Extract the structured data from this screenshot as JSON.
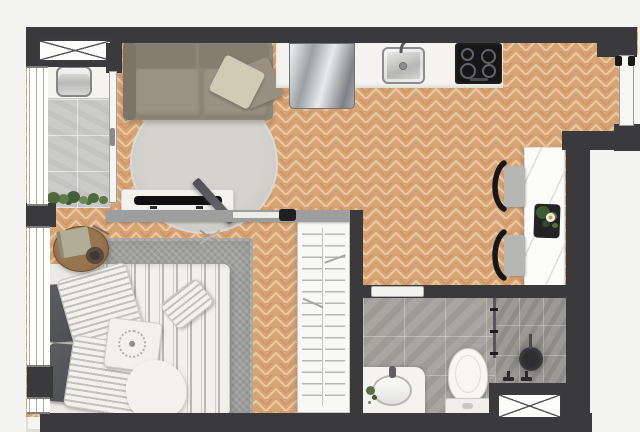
{
  "image_type": "apartment_floor_plan_rendering",
  "visible_text": [],
  "palette": {
    "exterior_bg": "#f4f4f2",
    "wall_dark": "#3a3a3c",
    "wall_partition_grey": "#9e9e9f",
    "wood_floor_base": "#d7a274",
    "wood_floor_light": "#e9c99f",
    "wood_floor_dark": "#c28a58",
    "balcony_tile": "#cbcbc9",
    "bathroom_tile": "#a7a6a1",
    "counter_white": "#f4f3ef",
    "sofa_taupe": "#8d8577",
    "rug_round_grey": "#cdccc7",
    "rug_bedroom_grey": "#a0a19f",
    "appliance_steel": "#9da0a3",
    "cooktop_black": "#161616",
    "plant_green": "#4e6a3d"
  },
  "rooms": [
    {
      "name": "balcony-laundry",
      "floor": "grey-tile",
      "fixtures": [
        "laundry-sink",
        "counter",
        "planter-shrubs",
        "shaft-window-x",
        "glazed-wall",
        "sliding-glass-door"
      ]
    },
    {
      "name": "living-room",
      "floor": "herringbone-wood",
      "fixtures": [
        "sofa",
        "sofa-pillows",
        "round-rug",
        "tv-console",
        "tv"
      ]
    },
    {
      "name": "kitchen",
      "floor": "herringbone-wood",
      "fixtures": [
        "refrigerator",
        "countertop",
        "kitchen-sink",
        "faucet",
        "cooktop-4-burners"
      ]
    },
    {
      "name": "dining-nook",
      "floor": "herringbone-wood",
      "fixtures": [
        "marble-bar-table",
        "chair",
        "chair",
        "potted-plant",
        "entrance-door"
      ]
    },
    {
      "name": "bedroom",
      "floor": "herringbone-wood",
      "fixtures": [
        "double-bed",
        "striped-duvet",
        "dark-pillows",
        "striped-pillows",
        "mandala-pillow",
        "throw-blanket",
        "area-rug",
        "round-side-table",
        "book",
        "bowl",
        "wardrobe-shelving",
        "swing-door",
        "window-wall"
      ]
    },
    {
      "name": "hallway",
      "floor": "herringbone-wood",
      "fixtures": [
        "sliding-door-track"
      ]
    },
    {
      "name": "bathroom",
      "floor": "grey-stone-tile",
      "fixtures": [
        "vanity-counter",
        "vanity-sink",
        "toilet",
        "shower-enclosure",
        "shower-head",
        "shower-valves",
        "glass-partition",
        "sliding-door",
        "shaft-window-x"
      ]
    }
  ],
  "openings": {
    "entrance_door": "right wall, top section",
    "balcony_door": "sliding glass, west side of living room",
    "bedroom_door": "swing door from living room",
    "bathroom_door": "pocket slider in bathroom north wall"
  }
}
